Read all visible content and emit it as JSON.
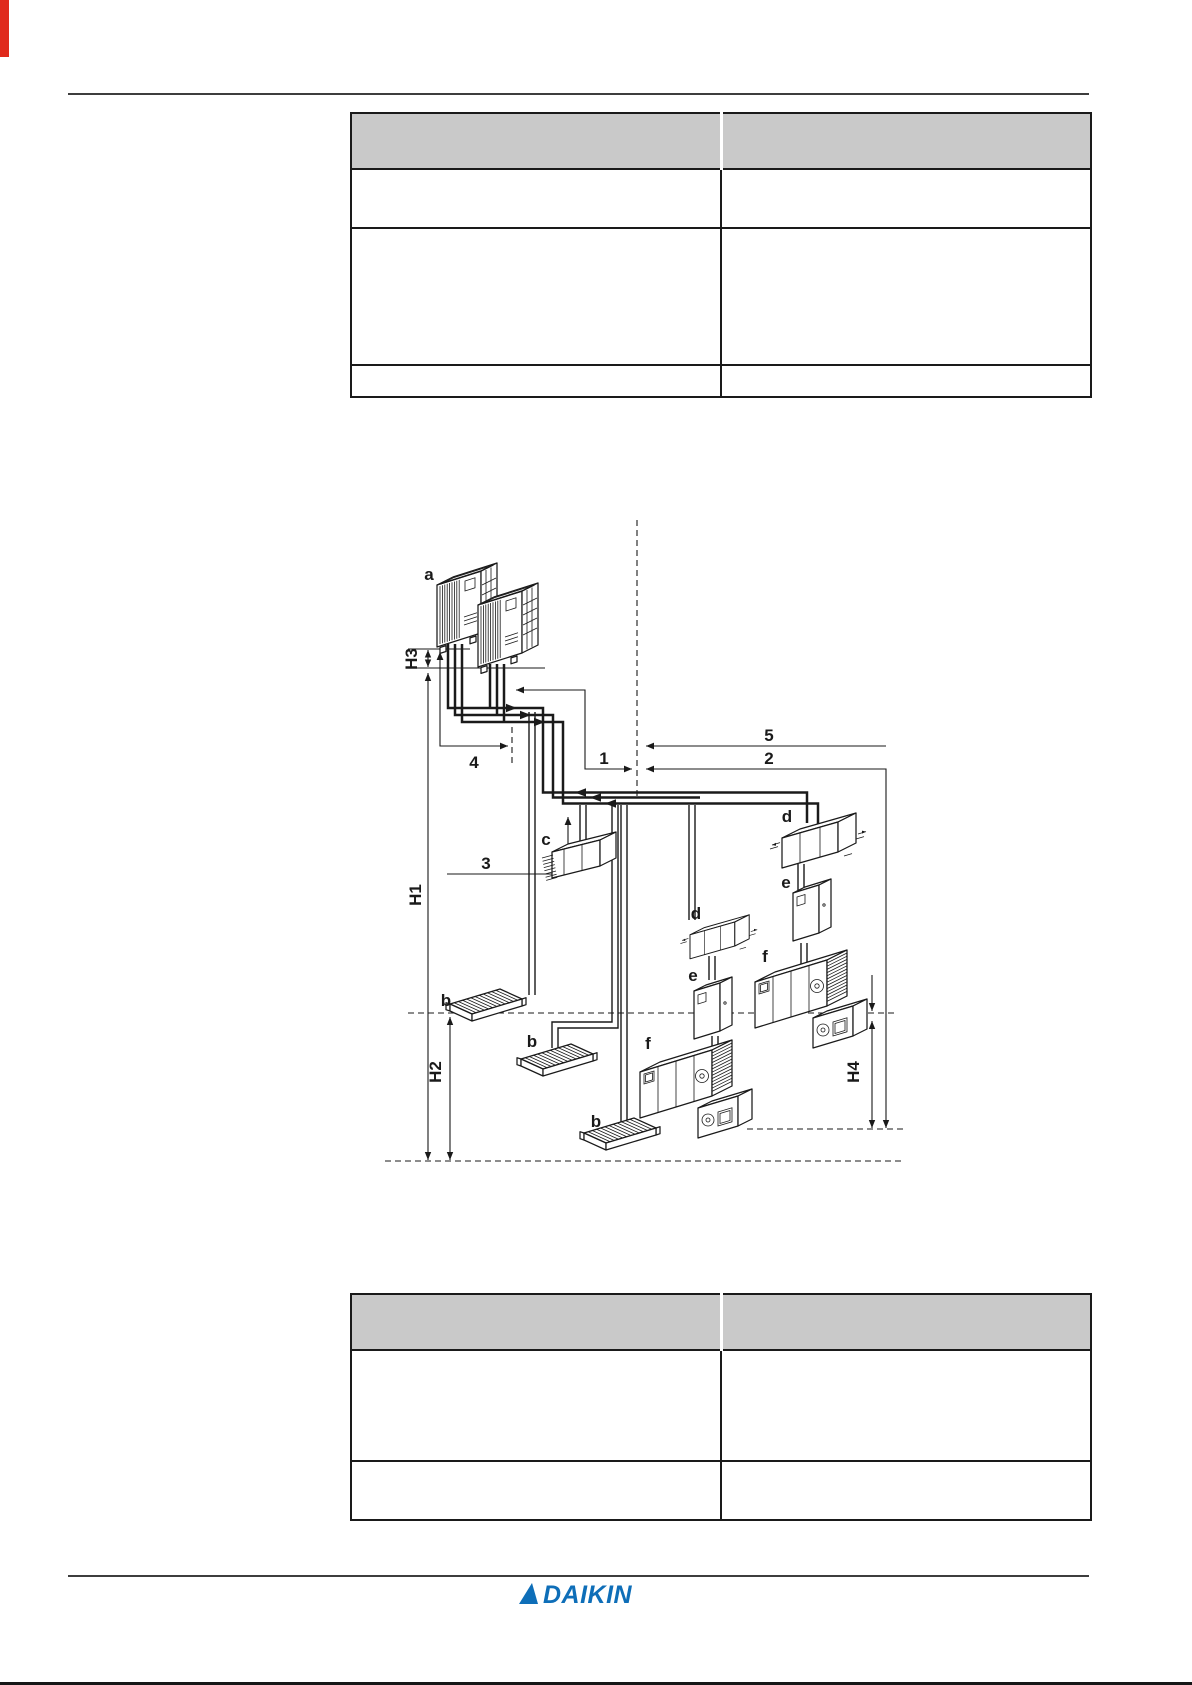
{
  "colors": {
    "accent_red": "#e02a1c",
    "daikin_blue": "#0e6eb8",
    "table_header_gray": "#c9c9c9",
    "rule_gray": "#3d3d3d",
    "ink": "#1a1a1a"
  },
  "tables": {
    "top": {
      "headers": [
        "",
        ""
      ],
      "rows": [
        [
          "",
          ""
        ],
        [
          "",
          ""
        ],
        [
          "",
          ""
        ]
      ]
    },
    "bottom": {
      "headers": [
        "",
        ""
      ],
      "rows": [
        [
          "",
          ""
        ],
        [
          "",
          ""
        ]
      ]
    }
  },
  "diagram": {
    "labels": {
      "unit_a": "a",
      "unit_b": "b",
      "unit_c": "c",
      "unit_d": "d",
      "unit_e": "e",
      "unit_f": "f",
      "h1": "H1",
      "h2": "H2",
      "h3": "H3",
      "h4": "H4",
      "n1": "1",
      "n2": "2",
      "n3": "3",
      "n4": "4",
      "n5": "5"
    }
  },
  "footer": {
    "brand": "DAIKIN"
  }
}
